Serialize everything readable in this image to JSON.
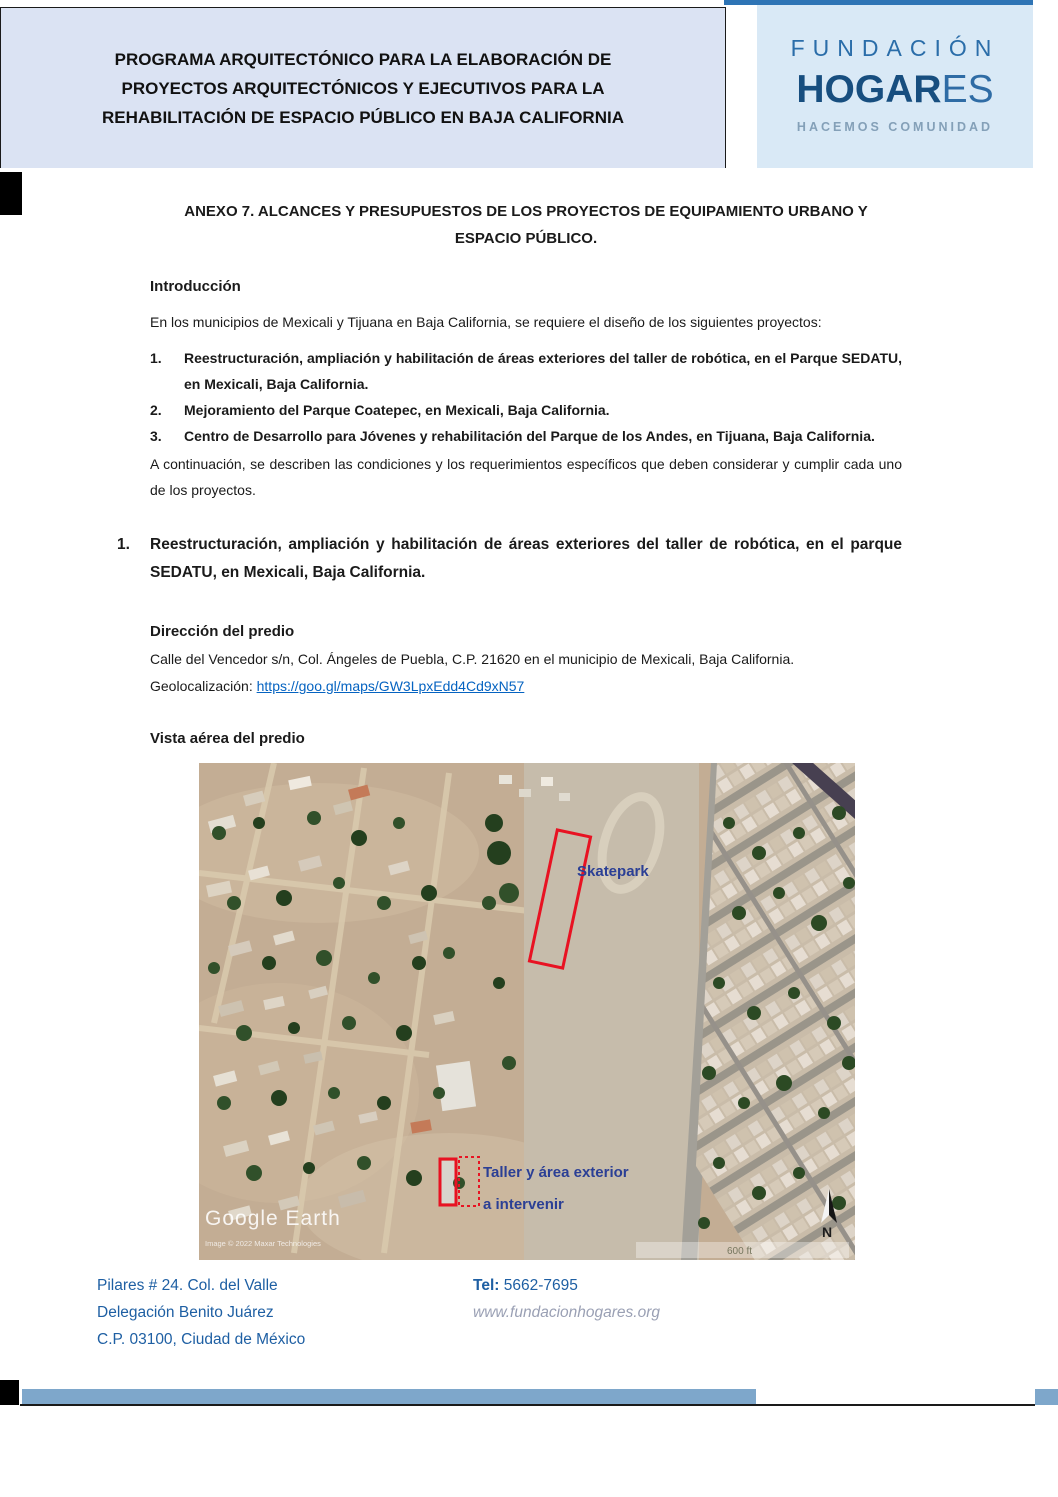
{
  "header": {
    "title_lines": [
      "PROGRAMA ARQUITECTÓNICO PARA LA ELABORACIÓN DE",
      "PROYECTOS ARQUITECTÓNICOS Y EJECUTIVOS PARA LA",
      "REHABILITACIÓN DE ESPACIO PÚBLICO EN BAJA CALIFORNIA"
    ]
  },
  "logo": {
    "name_top": "FUNDACIÓN",
    "name_bold": "HOGAR",
    "name_light": "ES",
    "tagline": "HACEMOS COMUNIDAD"
  },
  "document": {
    "anexo_title": "ANEXO 7. ALCANCES Y PRESUPUESTOS DE LOS PROYECTOS DE EQUIPAMIENTO URBANO Y ESPACIO PÚBLICO.",
    "intro_heading": "Introducción",
    "intro_paragraph": "En los municipios de Mexicali y Tijuana en Baja California, se requiere el diseño de los siguientes proyectos:",
    "project_list": [
      {
        "number": "1.",
        "text": "Reestructuración, ampliación y habilitación de áreas exteriores del taller de robótica, en el Parque SEDATU, en Mexicali, Baja California."
      },
      {
        "number": "2.",
        "text": "Mejoramiento del Parque Coatepec, en Mexicali, Baja California."
      },
      {
        "number": "3.",
        "text": "Centro de Desarrollo para Jóvenes y rehabilitación del Parque de los Andes, en Tijuana, Baja California."
      }
    ],
    "continuation_paragraph": " A continuación, se describen las condiciones y los requerimientos específicos que deben considerar y cumplir cada uno de los proyectos.",
    "section1": {
      "number": "1.",
      "title": "Reestructuración, ampliación y habilitación de áreas exteriores del taller de robótica, en el parque SEDATU, en Mexicali, Baja California.",
      "direccion_heading": "Dirección del predio",
      "direccion_text": "Calle del Vencedor s/n, Col. Ángeles de Puebla, C.P. 21620 en el municipio de Mexicali, Baja California.",
      "geo_label": "Geolocalización: ",
      "geo_link": "https://goo.gl/maps/GW3LpxEdd4Cd9xN57",
      "vista_heading": "Vista aérea del predio"
    }
  },
  "map": {
    "label_skatepark": "Skatepark",
    "label_taller_line1": "Taller y área exterior",
    "label_taller_line2": "a intervenir",
    "watermark": "Google Earth",
    "attribution": "Image © 2022 Maxar Technologies",
    "scale_label": "600 ft",
    "north_label": "N"
  },
  "footer": {
    "address_lines": [
      "Pilares # 24. Col. del Valle",
      "Delegación Benito Juárez",
      "C.P. 03100, Ciudad de México"
    ],
    "tel_label": "Tel:",
    "tel_number": " 5662-7695",
    "website": "www.fundacionhogares.org"
  },
  "colors": {
    "header_box": "#dbe3f3",
    "logo_box": "#d9e9f6",
    "logo_dark_blue": "#174e7f",
    "logo_medium_blue": "#2a6da9",
    "tagline_blue": "#84a0b8",
    "top_strip_blue": "#2e74b5",
    "footer_blue": "#1e5fa3",
    "link_blue": "#0563c1",
    "annotation_red": "#e81222",
    "map_label_blue": "#2b3f95",
    "bottom_bar_blue": "#7ea7cb"
  }
}
